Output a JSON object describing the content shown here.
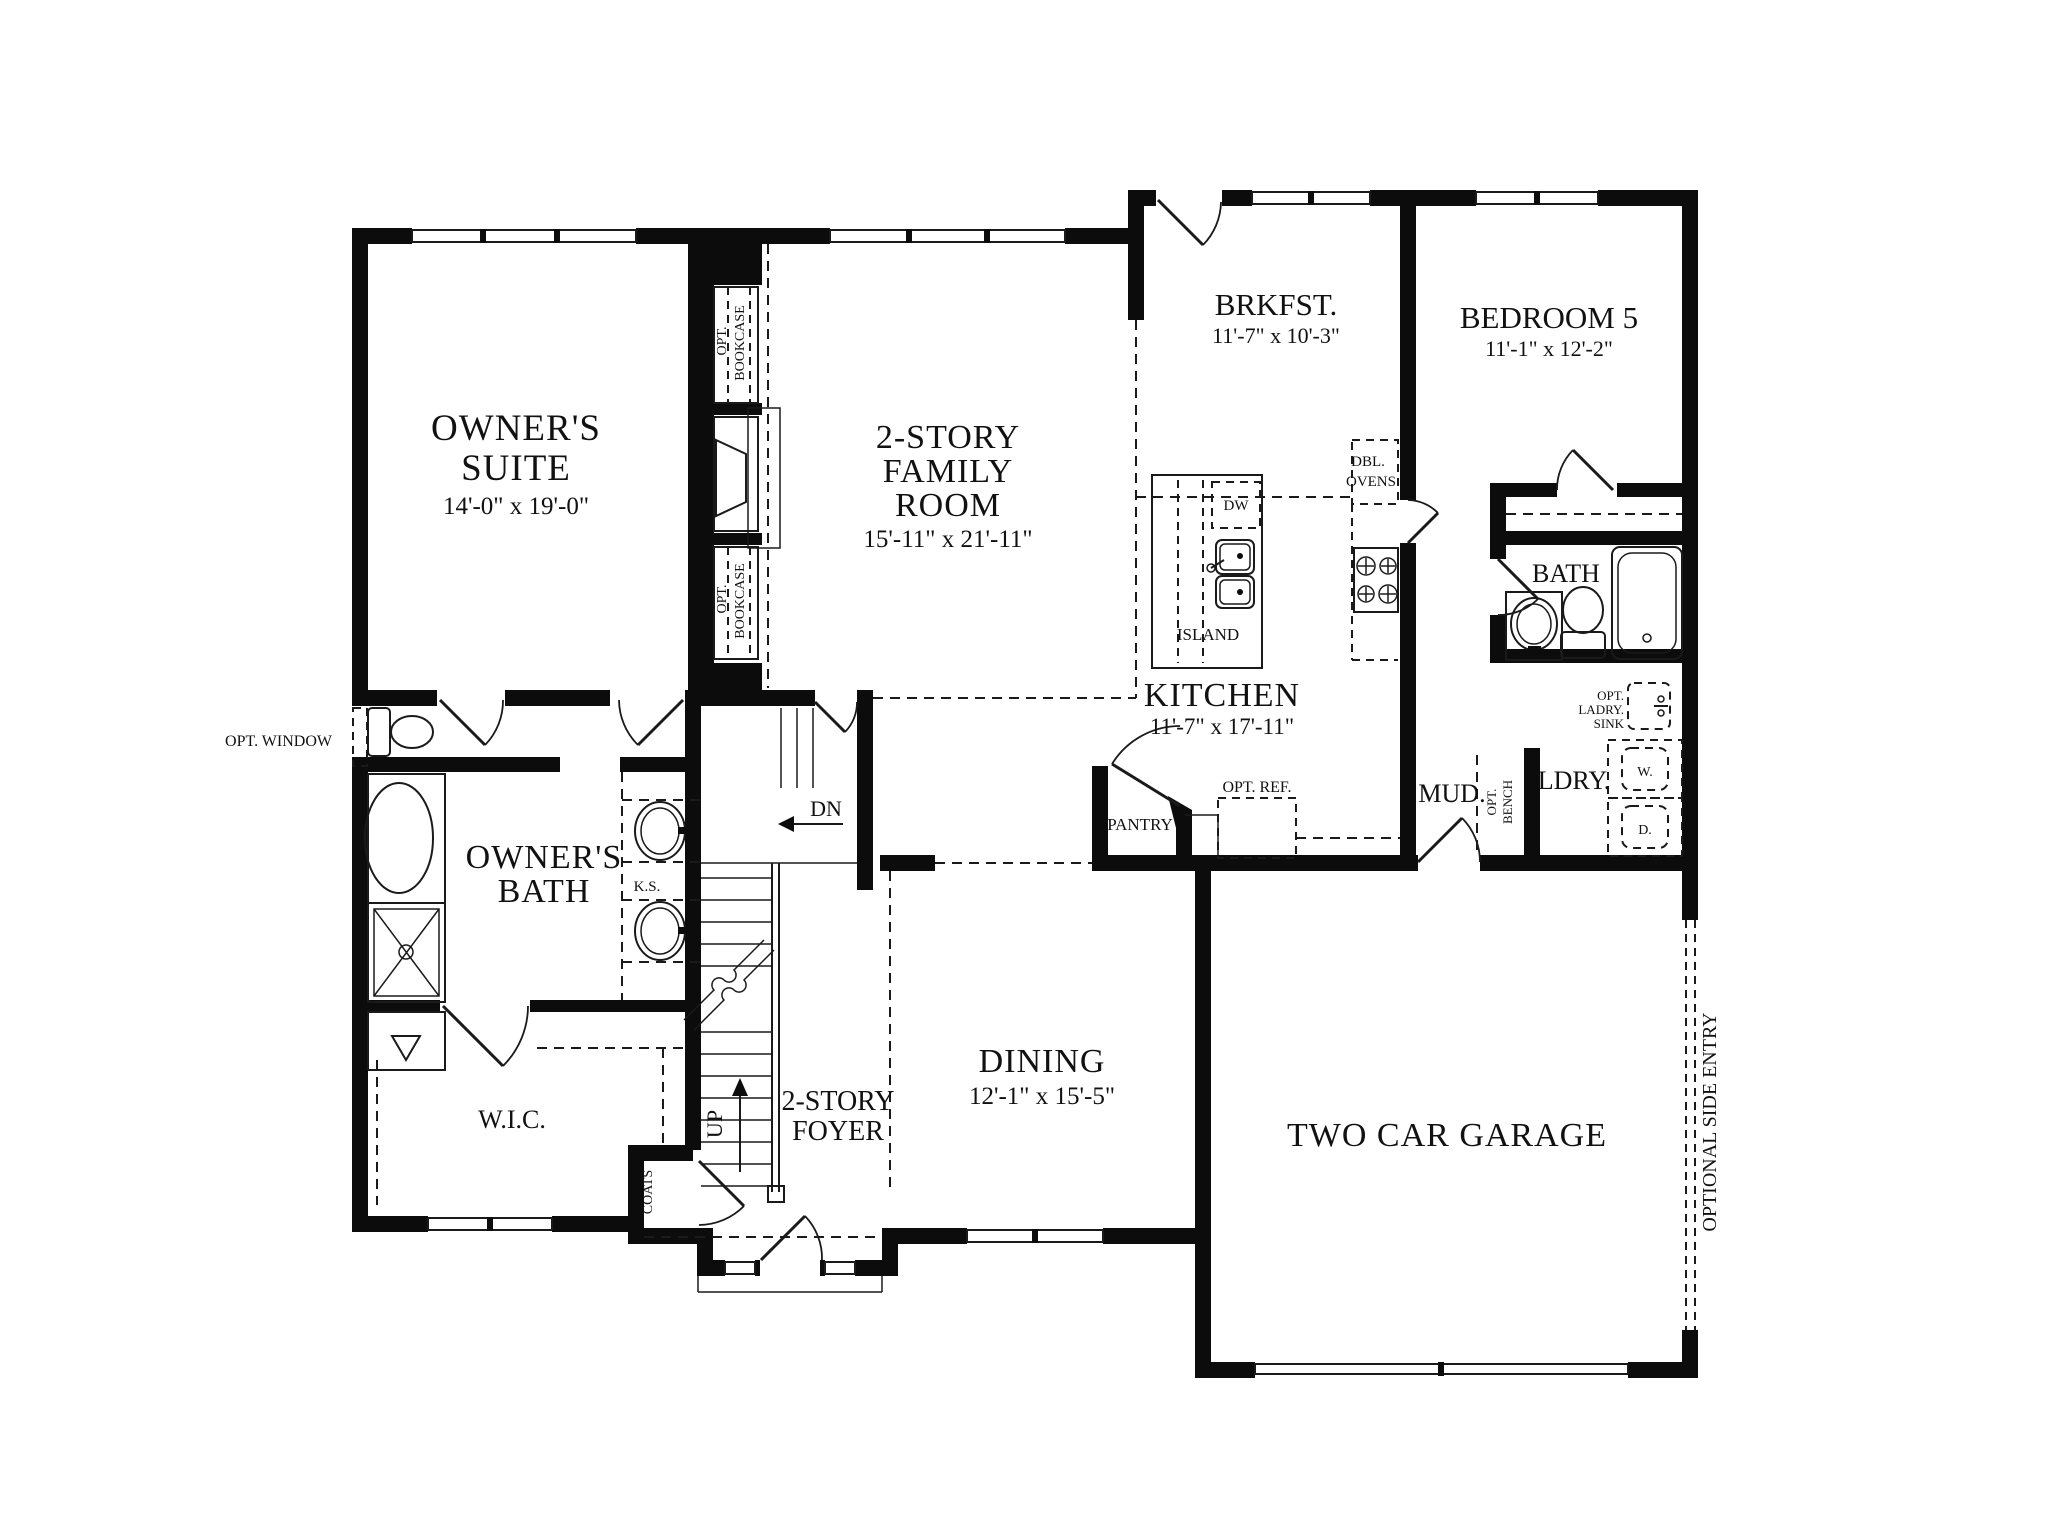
{
  "rooms": {
    "owners_suite": {
      "l1": "OWNER'S",
      "l2": "SUITE",
      "dims": "14'-0\" x 19'-0\""
    },
    "family_room": {
      "l1": "2-STORY",
      "l2": "FAMILY",
      "l3": "ROOM",
      "dims": "15'-11\" x 21'-11\""
    },
    "brkfst": {
      "l1": "BRKFST.",
      "dims": "11'-7\" x 10'-3\""
    },
    "bedroom5": {
      "l1": "BEDROOM 5",
      "dims": "11'-1\" x 12'-2\""
    },
    "kitchen": {
      "l1": "KITCHEN",
      "dims": "11'-7\" x 17'-11\""
    },
    "dining": {
      "l1": "DINING",
      "dims": "12'-1\" x 15'-5\""
    },
    "garage": {
      "l1": "TWO CAR GARAGE"
    },
    "foyer": {
      "l1": "2-STORY",
      "l2": "FOYER"
    },
    "owners_bath": {
      "l1": "OWNER'S",
      "l2": "BATH"
    },
    "wic": {
      "l1": "W.I.C."
    },
    "bath": {
      "l1": "BATH"
    },
    "mud": {
      "l1": "MUD."
    },
    "ldry": {
      "l1": "LDRY."
    },
    "pantry": {
      "l1": "PANTRY"
    }
  },
  "annotations": {
    "opt_window": "OPT. WINDOW",
    "opt_bookcase_l1": "OPT.",
    "opt_bookcase_l2": "BOOKCASE",
    "dbl_ovens_l1": "DBL.",
    "dbl_ovens_l2": "OVENS",
    "dw": "DW",
    "island": "ISLAND",
    "opt_ref": "OPT. REF.",
    "ks": "K.S.",
    "dn": "DN",
    "up": "UP",
    "coats": "COATS",
    "washer": "W.",
    "dryer": "D.",
    "opt_bench_l1": "OPT.",
    "opt_bench_l2": "BENCH",
    "opt_ldry_l1": "OPT.",
    "opt_ldry_l2": "LADRY.",
    "opt_ldry_l3": "SINK",
    "side_entry": "OPTIONAL SIDE ENTRY"
  }
}
